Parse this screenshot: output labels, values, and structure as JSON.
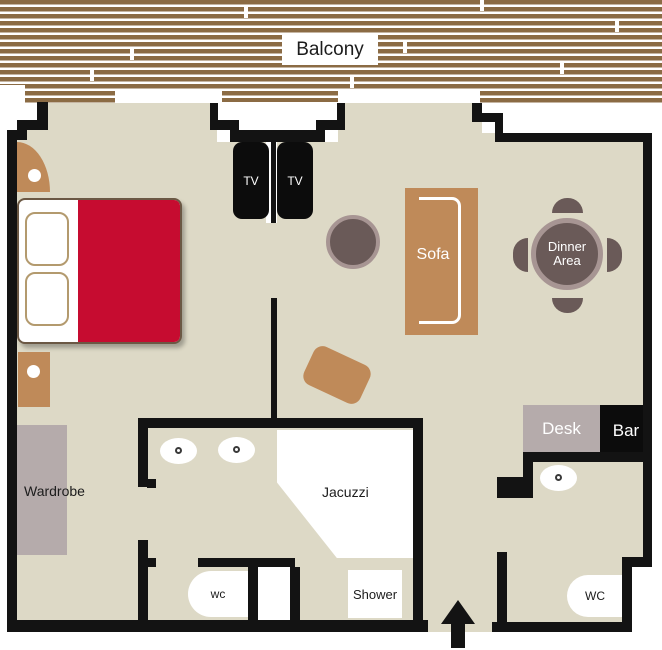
{
  "labels": {
    "balcony": "Balcony",
    "tv_left": "TV",
    "tv_right": "TV",
    "sofa": "Sofa",
    "dinner_line1": "Dinner",
    "dinner_line2": "Area",
    "desk": "Desk",
    "bar": "Bar",
    "wardrobe": "Wardrobe",
    "jacuzzi": "Jacuzzi",
    "wc_main": "wc",
    "shower": "Shower",
    "wc_guest": "WC"
  },
  "colors": {
    "floor": "#ddd9c6",
    "wall": "#131313",
    "wood": "#8b6b44",
    "furn": "#bf8a59",
    "red": "#c60c30",
    "gray": "#b5abab",
    "dark": "#6a5a58",
    "ring": "#a79593"
  }
}
